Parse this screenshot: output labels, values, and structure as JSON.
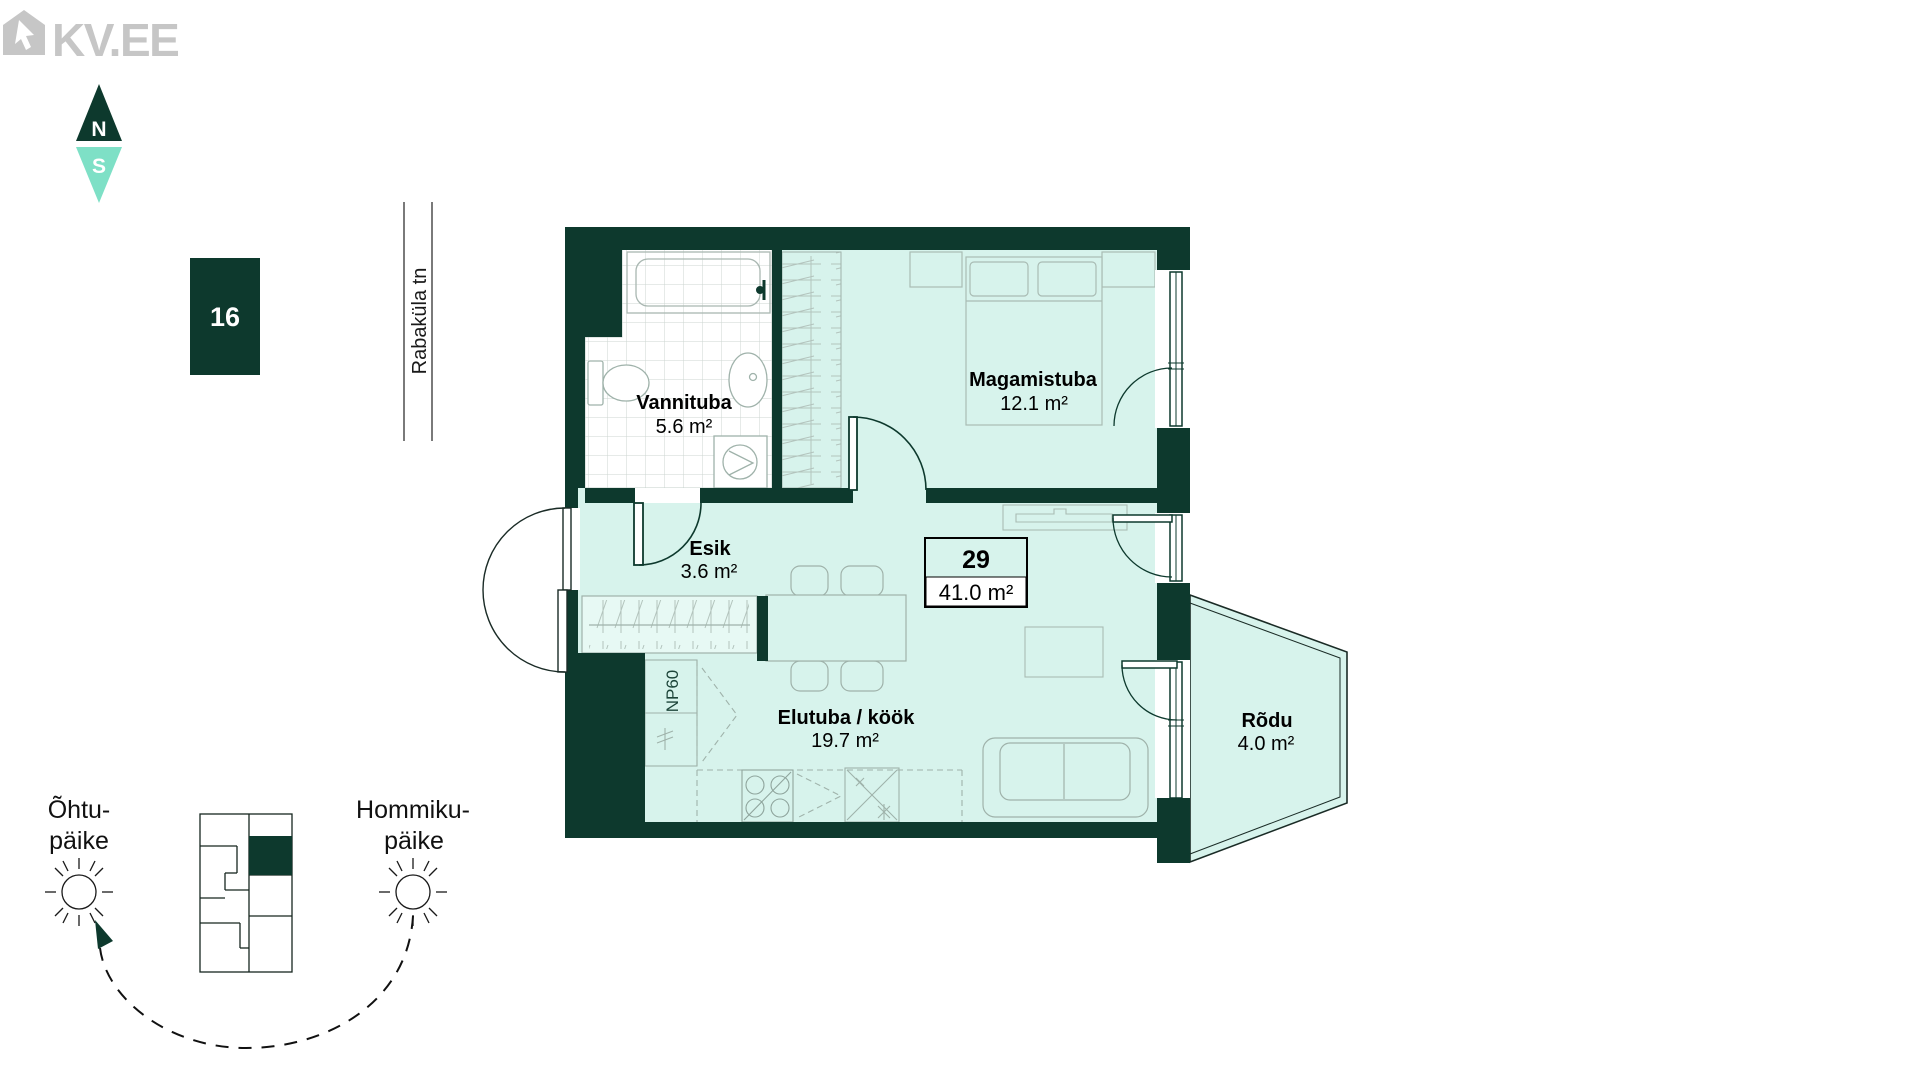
{
  "branding": {
    "logo_text": "KV.EE"
  },
  "compass": {
    "north_label": "N",
    "south_label": "S"
  },
  "stack_badge": {
    "number": "16"
  },
  "street": {
    "name": "Rabaküla tn"
  },
  "apartment": {
    "number": "29",
    "total_area": "41.0 m²"
  },
  "rooms": [
    {
      "id": "vannituba",
      "name": "Vannituba",
      "area": "5.6 m²"
    },
    {
      "id": "magamistuba",
      "name": "Magamistuba",
      "area": "12.1 m²"
    },
    {
      "id": "esik",
      "name": "Esik",
      "area": "3.6 m²"
    },
    {
      "id": "elutuba",
      "name": "Elutuba / köök",
      "area": "19.7 m²"
    },
    {
      "id": "rodu",
      "name": "Rõdu",
      "area": "4.0 m²"
    }
  ],
  "annotations": {
    "kitchen_niche": "NP60"
  },
  "sun_labels": {
    "evening_line1": "Õhtu-",
    "evening_line2": "päike",
    "morning_line1": "Hommiku-",
    "morning_line2": "päike"
  },
  "colors": {
    "wall_green": "#0d392d",
    "room_mint": "#d7f3ec",
    "accent_mint": "#7ee0c6",
    "logo_gray": "#c6c6c6"
  }
}
